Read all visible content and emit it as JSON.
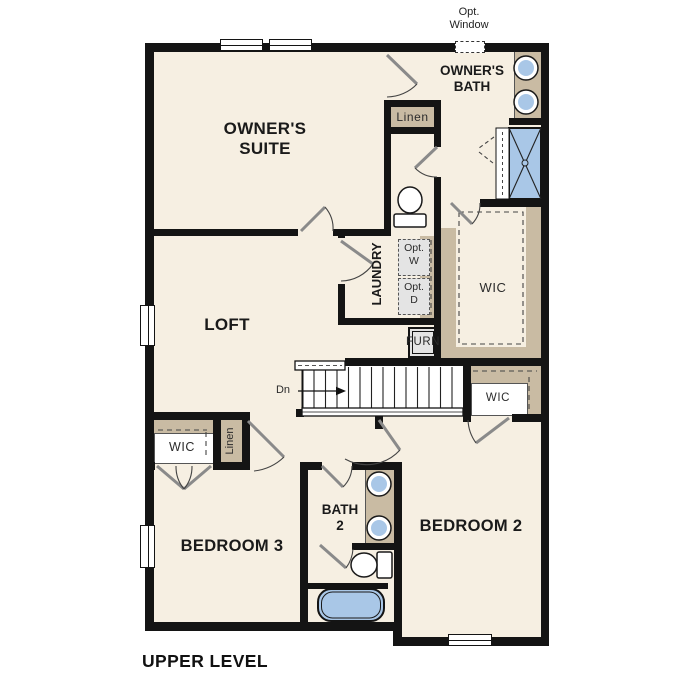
{
  "title": "UPPER LEVEL",
  "colors": {
    "floor": "#f6efe2",
    "tan": "#c9bba3",
    "wall": "#141414",
    "fixture_blue": "#a9c7e7",
    "appliance": "#e4e4e4"
  },
  "rooms": {
    "owners_suite": {
      "line1": "OWNER'S",
      "line2": "SUITE"
    },
    "owners_bath": {
      "line1": "OWNER'S",
      "line2": "BATH"
    },
    "loft": {
      "label": "LOFT"
    },
    "laundry": {
      "label": "LAUNDRY"
    },
    "bath2": {
      "line1": "BATH",
      "line2": "2"
    },
    "bedroom2": {
      "label": "BEDROOM 2"
    },
    "bedroom3": {
      "label": "BEDROOM 3"
    }
  },
  "closets": {
    "wic_owner": "WIC",
    "wic_bed2": "WIC",
    "wic_bed3": "WIC",
    "linen_hall": "Linen",
    "linen_bed3": "Linen"
  },
  "fixtures": {
    "furnace": "FURN",
    "opt_washer_line1": "Opt.",
    "opt_washer_line2": "W",
    "opt_dryer_line1": "Opt.",
    "opt_dryer_line2": "D"
  },
  "stairs": {
    "direction": "Dn"
  },
  "annotations": {
    "opt_window_line1": "Opt.",
    "opt_window_line2": "Window"
  }
}
